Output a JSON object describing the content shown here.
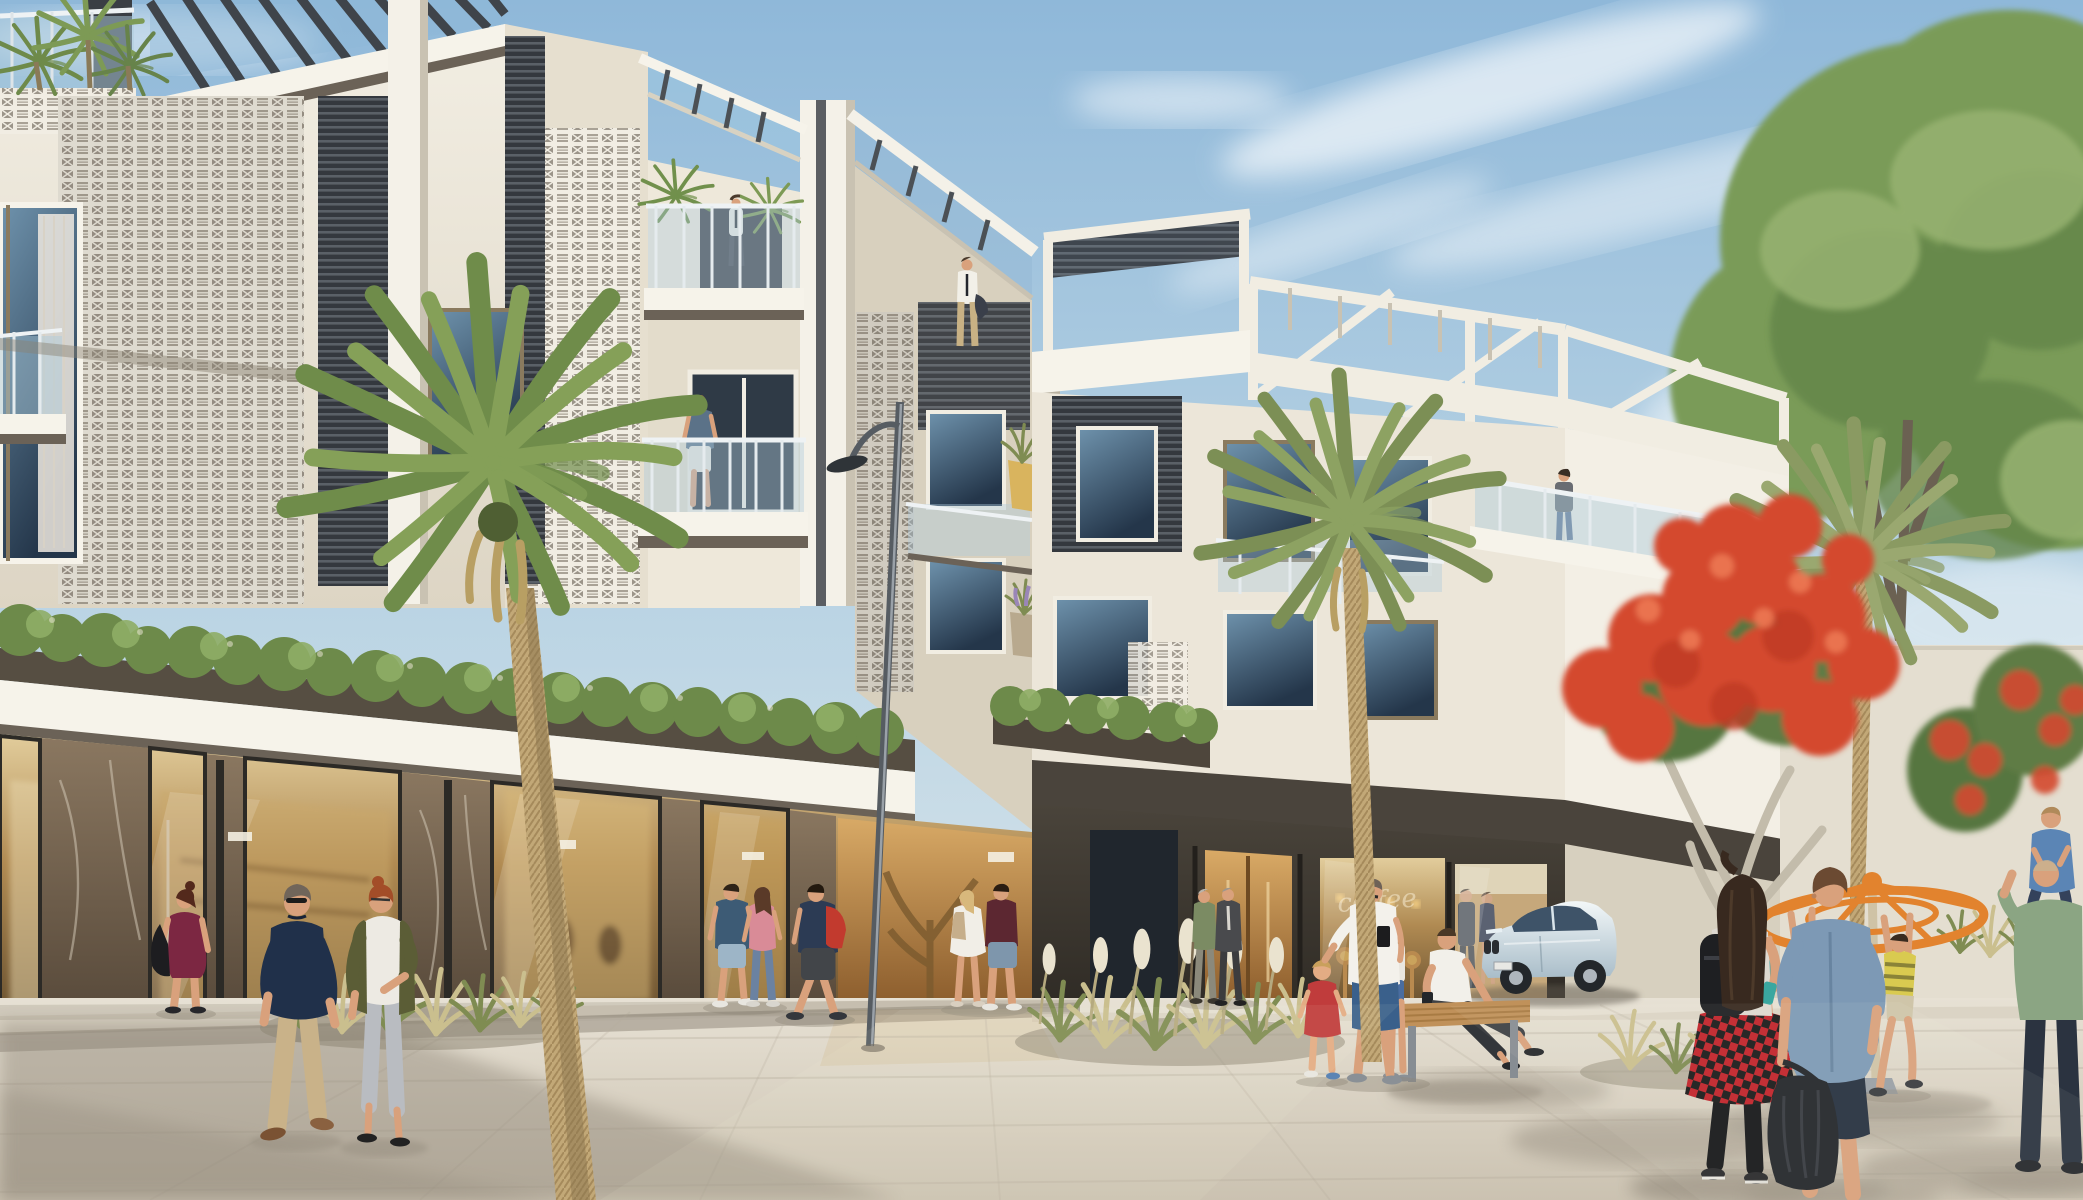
{
  "scene": {
    "description": "Sunny architectural rendering of a modern 3-4 storey shophouse complex with rooftop pergolas, perforated breeze-block screens, glass balconies, marble storefronts, a paved plaza with pedestrians, palm trees, a flowering flame tree, a parked coupe and a children's playground carousel",
    "people": [
      "man-on-rooftop-terrace",
      "man-on-upper-terrace",
      "man-on-balcony",
      "woman-on-right-terrace",
      "woman-maroon-dress",
      "man-navy-polo",
      "woman-olive-jacket",
      "couple-entering-store",
      "man-red-backpack",
      "woman-white-dress",
      "man-maroon-tee",
      "two-elderly-men",
      "father-with-toddler",
      "toddler-red-dress",
      "man-on-bench",
      "person-beside-bench",
      "foreground-woman-checkered-skirt",
      "foreground-man-chambray-shirt",
      "man-carrying-child-on-shoulders",
      "child-on-shoulders",
      "girl-on-carousel",
      "boy-on-carousel",
      "small-child-at-carousel",
      "lobby-man-suit",
      "lobby-woman"
    ]
  },
  "palette": {
    "sky_top": "#8fb8d9",
    "sky_mid": "#bad4e4",
    "sky_bottom": "#e3eaec",
    "cloud": "#ffffff",
    "facade_cream": "#efe9dc",
    "facade_shade": "#ddd5c4",
    "facade_dark": "#cfc7b5",
    "trim_white": "#f6f3ea",
    "slab_dark": "#564e42",
    "soffit": "#6b6257",
    "breeze_face": "#f1ede3",
    "breeze_cell": "#9c958a",
    "louver_dark": "#34383e",
    "louver_line": "#5a6067",
    "window_deep": "#24364a",
    "window_sky": "#6f93ad",
    "rail_glass": "#b7d0dc",
    "rail_post": "#eef2f4",
    "hedge_green": "#6d8a4a",
    "hedge_light": "#8fae66",
    "hedge_dark": "#52703a",
    "marble_brown_hi": "#8a7760",
    "marble_brown_lo": "#57493a",
    "marble_dark_hi": "#4a443b",
    "marble_dark_lo": "#2e2a24",
    "glow_hi": "#e2cd9c",
    "glow_mid": "#b08a52",
    "glow_lo": "#68502f",
    "bronze_hi": "#d9aa66",
    "bronze_lo": "#8a5a2a",
    "pave_light": "#e7e1d4",
    "pave_dark": "#cbc2b1",
    "sidewalk": "#d8d1c2",
    "asphalt": "#a59d90",
    "shadow": "#8f8678",
    "tree_green": "#7a9b58",
    "tree_dark": "#648548",
    "tree_light": "#97b271",
    "palm_green": "#6f8c4a",
    "palm_olive": "#8a9a62",
    "palm_trunk": "#c2a877",
    "flame_red": "#d4492f",
    "flame_deep": "#bf3a24",
    "flame_green": "#56763f",
    "wall_light": "#ece6d8",
    "lamp_metal": "#565c62",
    "skin": "#d9a17c"
  },
  "people": {
    "roof_man": {
      "shirt": "#f2f0e8",
      "pants": "#c8b184"
    },
    "upper_man": {
      "shirt": "#eceae2",
      "pants": "#4a4e55"
    },
    "balcony_man": {
      "shirt": "#5b7288",
      "shorts": "#e9e6dd"
    },
    "terrace_woman": {
      "top": "#696c72",
      "jeans": "#5d7290"
    },
    "maroon_woman": {
      "dress": "#7c2742",
      "bag": "#1d1d20"
    },
    "navy_man": {
      "shirt": "#20304a",
      "pants": "#c9b289"
    },
    "olive_woman": {
      "jacket": "#5b5d36",
      "shirt": "#edeae3",
      "jeans": "#b9bcc1"
    },
    "storeA_man": {
      "shirt": "#3d5b75",
      "shorts": "#9db5c7"
    },
    "storeA_woman": {
      "top": "#d98b97",
      "jeans": "#6b82a1"
    },
    "redpack_man": {
      "shirt": "#2c3b54",
      "pack": "#c23a2e",
      "shorts": "#424549"
    },
    "whitedress_woman": {
      "dress": "#f1eee7",
      "pack": "#c6ae8b"
    },
    "maroontee_man": {
      "shirt": "#5c2731",
      "shorts": "#7e96ac"
    },
    "old_green": {
      "shirt": "#7b8b63",
      "pants": "#8b897b"
    },
    "old_suit": {
      "suit": "#494a4d"
    },
    "father": {
      "shirt": "#f3f1eb",
      "shorts": "#3a608b",
      "patch": "#1c1c1e"
    },
    "toddler": {
      "dress": "#c03c3c"
    },
    "bench_man": {
      "shirt": "#f2f0ea",
      "pants": "#3e4145"
    },
    "bench_side": {
      "top": "#e9e6df",
      "shorts": "#4a6da0"
    },
    "fg_woman": {
      "hair": "#38291f",
      "backpack": "#1e1f22",
      "skirt_red": "#c1242b",
      "skirt_black": "#1b1b1b",
      "leggings": "#17181a"
    },
    "fg_man": {
      "shirt": "#7d99b5",
      "shorts": "#273140",
      "bag": "#24272b"
    },
    "green_man": {
      "shirt": "#8ba583",
      "pants": "#2b3340"
    },
    "shoulder_child": {
      "shirt": "#5b85b5",
      "pants": "#34425b"
    },
    "girl_pink": {
      "shirt": "#e87b9d",
      "shorts": "#cfc0a1"
    },
    "boy_yellow": {
      "shirt": "#d9ca50",
      "stripe": "#8a8338",
      "shorts": "#cfc5a9"
    },
    "kid_teal": {
      "shirt": "#4aa1a1"
    },
    "lobby_man": {
      "suit": "#2e3a4b"
    },
    "lobby_woman": {
      "dress": "#31405c"
    }
  },
  "vehicle": {
    "car": {
      "label": "white coupe",
      "body_hi": "#f2f7f8",
      "body_lo": "#a9bdc9",
      "glass": "#3e5368",
      "wheel": "#23272b",
      "rim": "#aeb6bd"
    }
  },
  "equipment": {
    "carousel_orange": "#e2832e",
    "bench_wood": "#c0915a",
    "bench_wood_dark": "#a87b43",
    "lamp_head": "#2f3438"
  },
  "signage": {
    "cafe_window_script": "coffee"
  }
}
